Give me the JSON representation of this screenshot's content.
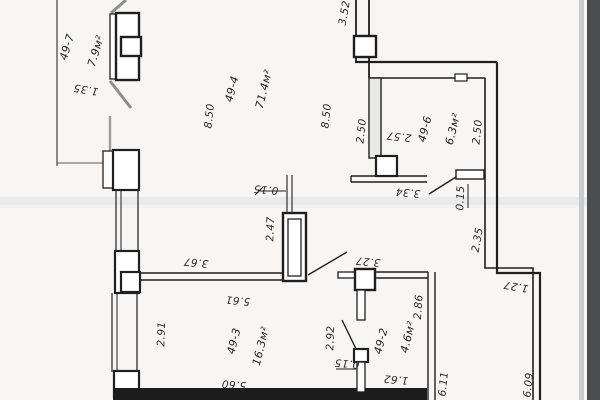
{
  "document": {
    "kind": "scanned apartment floor plan",
    "background_color": "#f7f6f4",
    "ink_color": "#1f1f1f",
    "glass_fill_color": "#e9e9e7",
    "scan_band_color": "#dde2e7",
    "scan_edge_light": "#c8cccf",
    "scan_edge_dark": "#4b4d4e"
  },
  "rooms": [
    {
      "number": "49-7",
      "area": "7.9м²"
    },
    {
      "number": "49-4",
      "area": "71.4м²"
    },
    {
      "number": "49-6",
      "area": "6.3м²"
    },
    {
      "number": "49-3",
      "area": "16.3м²"
    },
    {
      "number": "49-2",
      "area": "4.6м²"
    }
  ],
  "dimensions": {
    "d1_35": "1.35",
    "d3_52": "3.52",
    "d8_50_left": "8.50",
    "d8_50_right": "8.50",
    "d2_50_left": "2.50",
    "d2_57": "2.57",
    "d2_50_right": "2.50",
    "d3_34": "3.34",
    "d0_15_right": "0.15",
    "d2_35": "2.35",
    "d1_27": "1.27",
    "d0_15_mid": "0.15",
    "d2_47": "2.47",
    "d3_67": "3.67",
    "d5_61": "5.61",
    "d2_91": "2.91",
    "d3_27": "3.27",
    "d2_92": "2.92",
    "d0_15_low": "0.15",
    "d1_62": "1.62",
    "d2_86": "2.86",
    "d5_60": "5.60",
    "d6_11": "6.11",
    "d6_09": "6.09"
  }
}
